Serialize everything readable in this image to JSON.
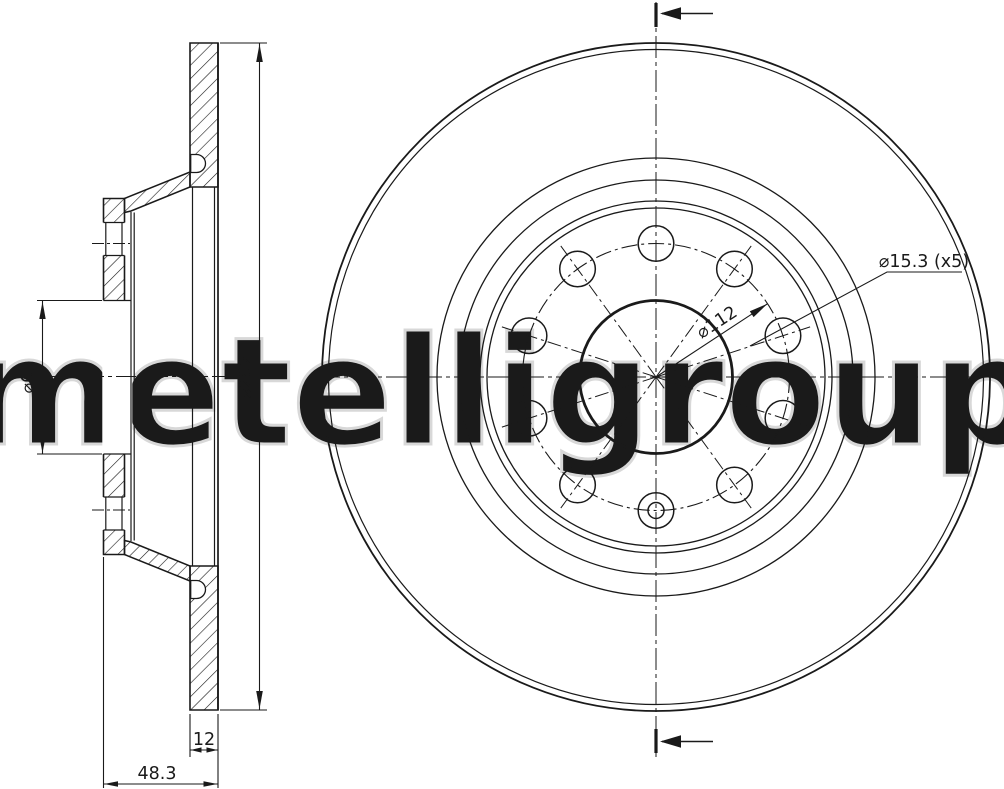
{
  "watermark": "metelligroup",
  "colors": {
    "line": "#1a1a1a",
    "watermark_outline": "#d8d8d8",
    "background": "#ffffff"
  },
  "section_view": {
    "outer_diameter_label": "⌀282",
    "bore_diameter_label": "⌀65",
    "thickness_label": "12",
    "overall_width_label": "48.3"
  },
  "front_view": {
    "bolt_circle_label": "⌀112",
    "bolt_holes_label": "⌀15.3 (x5)"
  }
}
